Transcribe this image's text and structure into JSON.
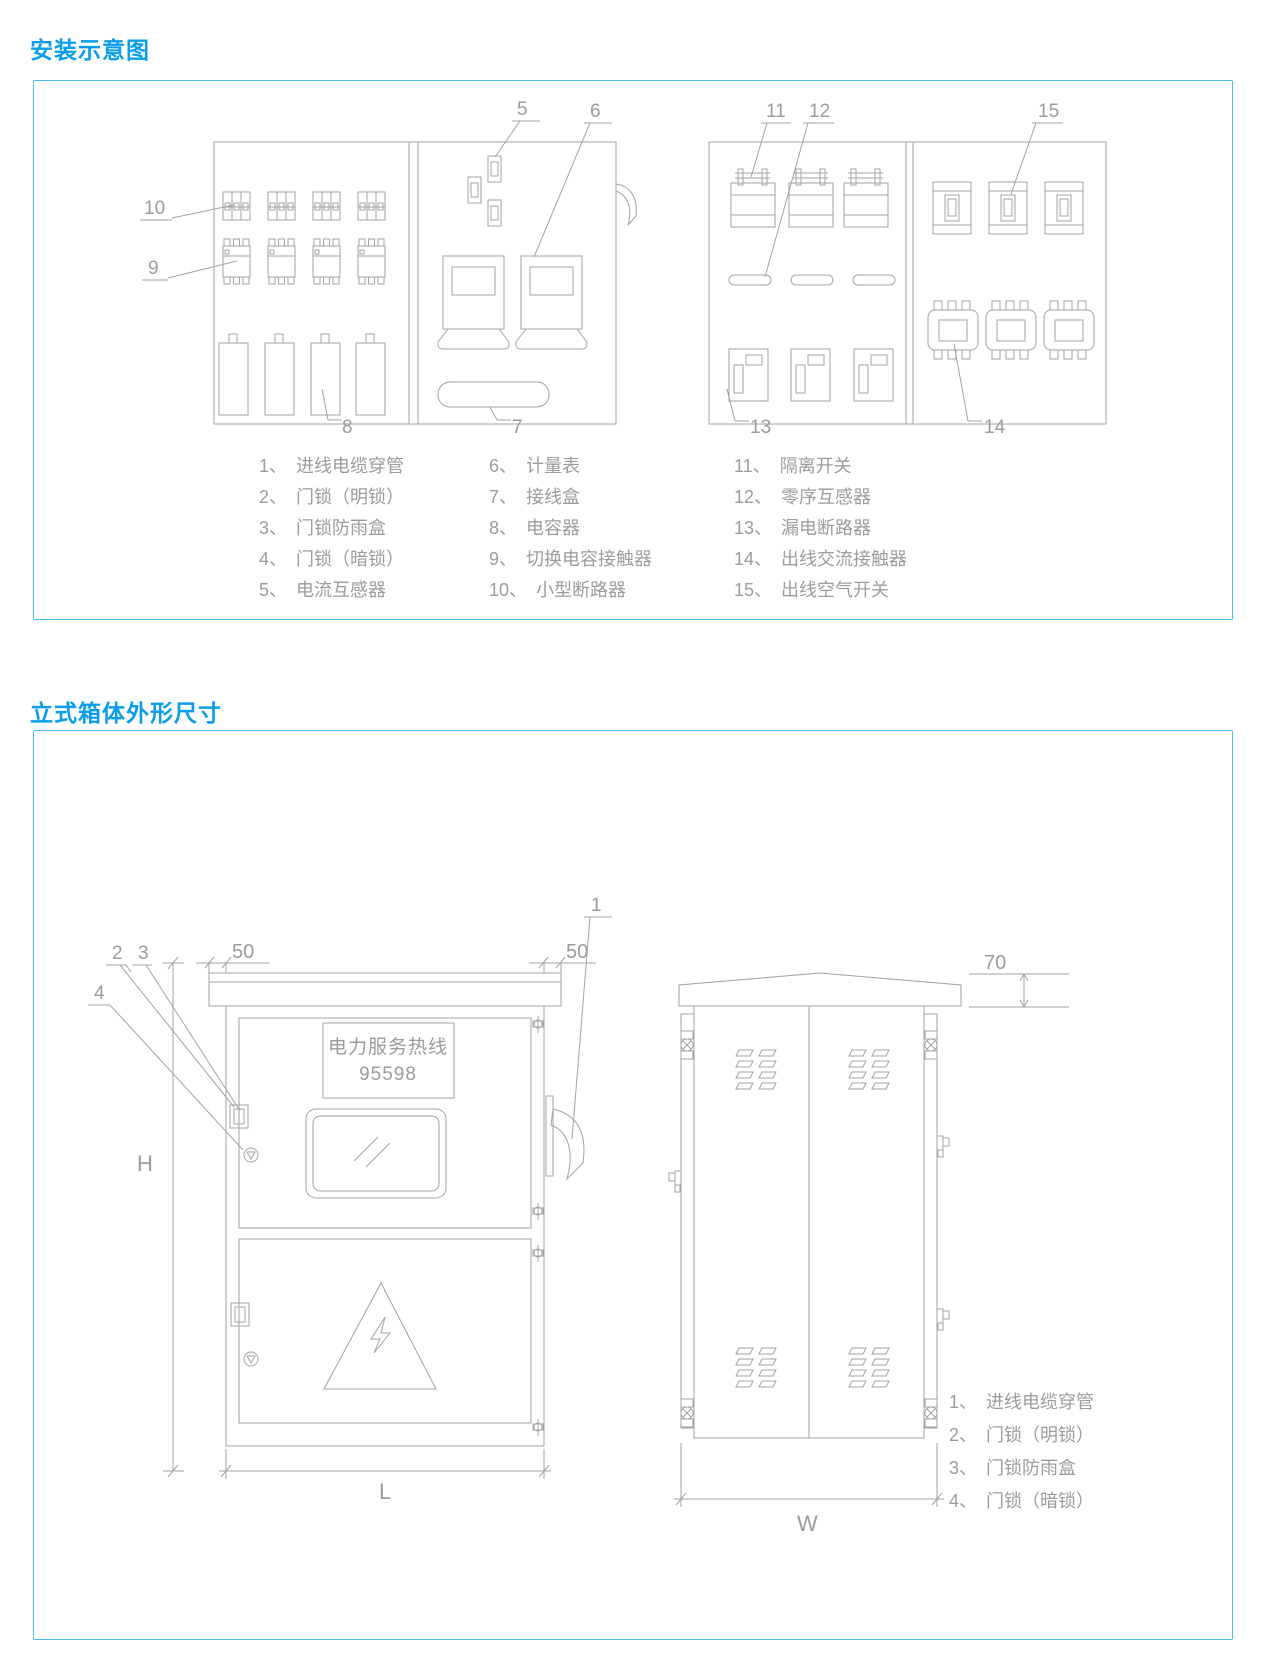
{
  "colors": {
    "accent": "#0b9de8",
    "panel_border": "#49bef0",
    "drawing_line": "#a3a3a3",
    "legend_text": "#9c9c9c"
  },
  "section1": {
    "title": "安装示意图",
    "callouts": {
      "c5": "5",
      "c6": "6",
      "c7": "7",
      "c8": "8",
      "c9": "9",
      "c10": "10",
      "c11": "11",
      "c12": "12",
      "c13": "13",
      "c14": "14",
      "c15": "15"
    },
    "legend_col1": [
      {
        "num": "1、",
        "label": "进线电缆穿管"
      },
      {
        "num": "2、",
        "label": "门锁（明锁）"
      },
      {
        "num": "3、",
        "label": "门锁防雨盒"
      },
      {
        "num": "4、",
        "label": "门锁（暗锁）"
      },
      {
        "num": "5、",
        "label": "电流互感器"
      }
    ],
    "legend_col2": [
      {
        "num": "6、",
        "label": "计量表"
      },
      {
        "num": "7、",
        "label": "接线盒"
      },
      {
        "num": "8、",
        "label": "电容器"
      },
      {
        "num": "9、",
        "label": "切换电容接触器"
      },
      {
        "num": "10、",
        "label": "小型断路器"
      }
    ],
    "legend_col3": [
      {
        "num": "11、",
        "label": "隔离开关"
      },
      {
        "num": "12、",
        "label": "零序互感器"
      },
      {
        "num": "13、",
        "label": "漏电断路器"
      },
      {
        "num": "14、",
        "label": "出线交流接触器"
      },
      {
        "num": "15、",
        "label": "出线空气开关"
      }
    ]
  },
  "section2": {
    "title": "立式箱体外形尺寸",
    "sign_line1": "电力服务热线",
    "sign_line2": "95598",
    "dims": {
      "left_overhang": "50",
      "right_overhang": "50",
      "roof_height": "70",
      "height": "H",
      "length": "L",
      "width": "W"
    },
    "callouts": {
      "c1": "1",
      "c2": "2",
      "c3": "3",
      "c4": "4"
    },
    "legend": [
      {
        "num": "1、",
        "label": "进线电缆穿管"
      },
      {
        "num": "2、",
        "label": "门锁（明锁）"
      },
      {
        "num": "3、",
        "label": "门锁防雨盒"
      },
      {
        "num": "4、",
        "label": "门锁（暗锁）"
      }
    ]
  }
}
